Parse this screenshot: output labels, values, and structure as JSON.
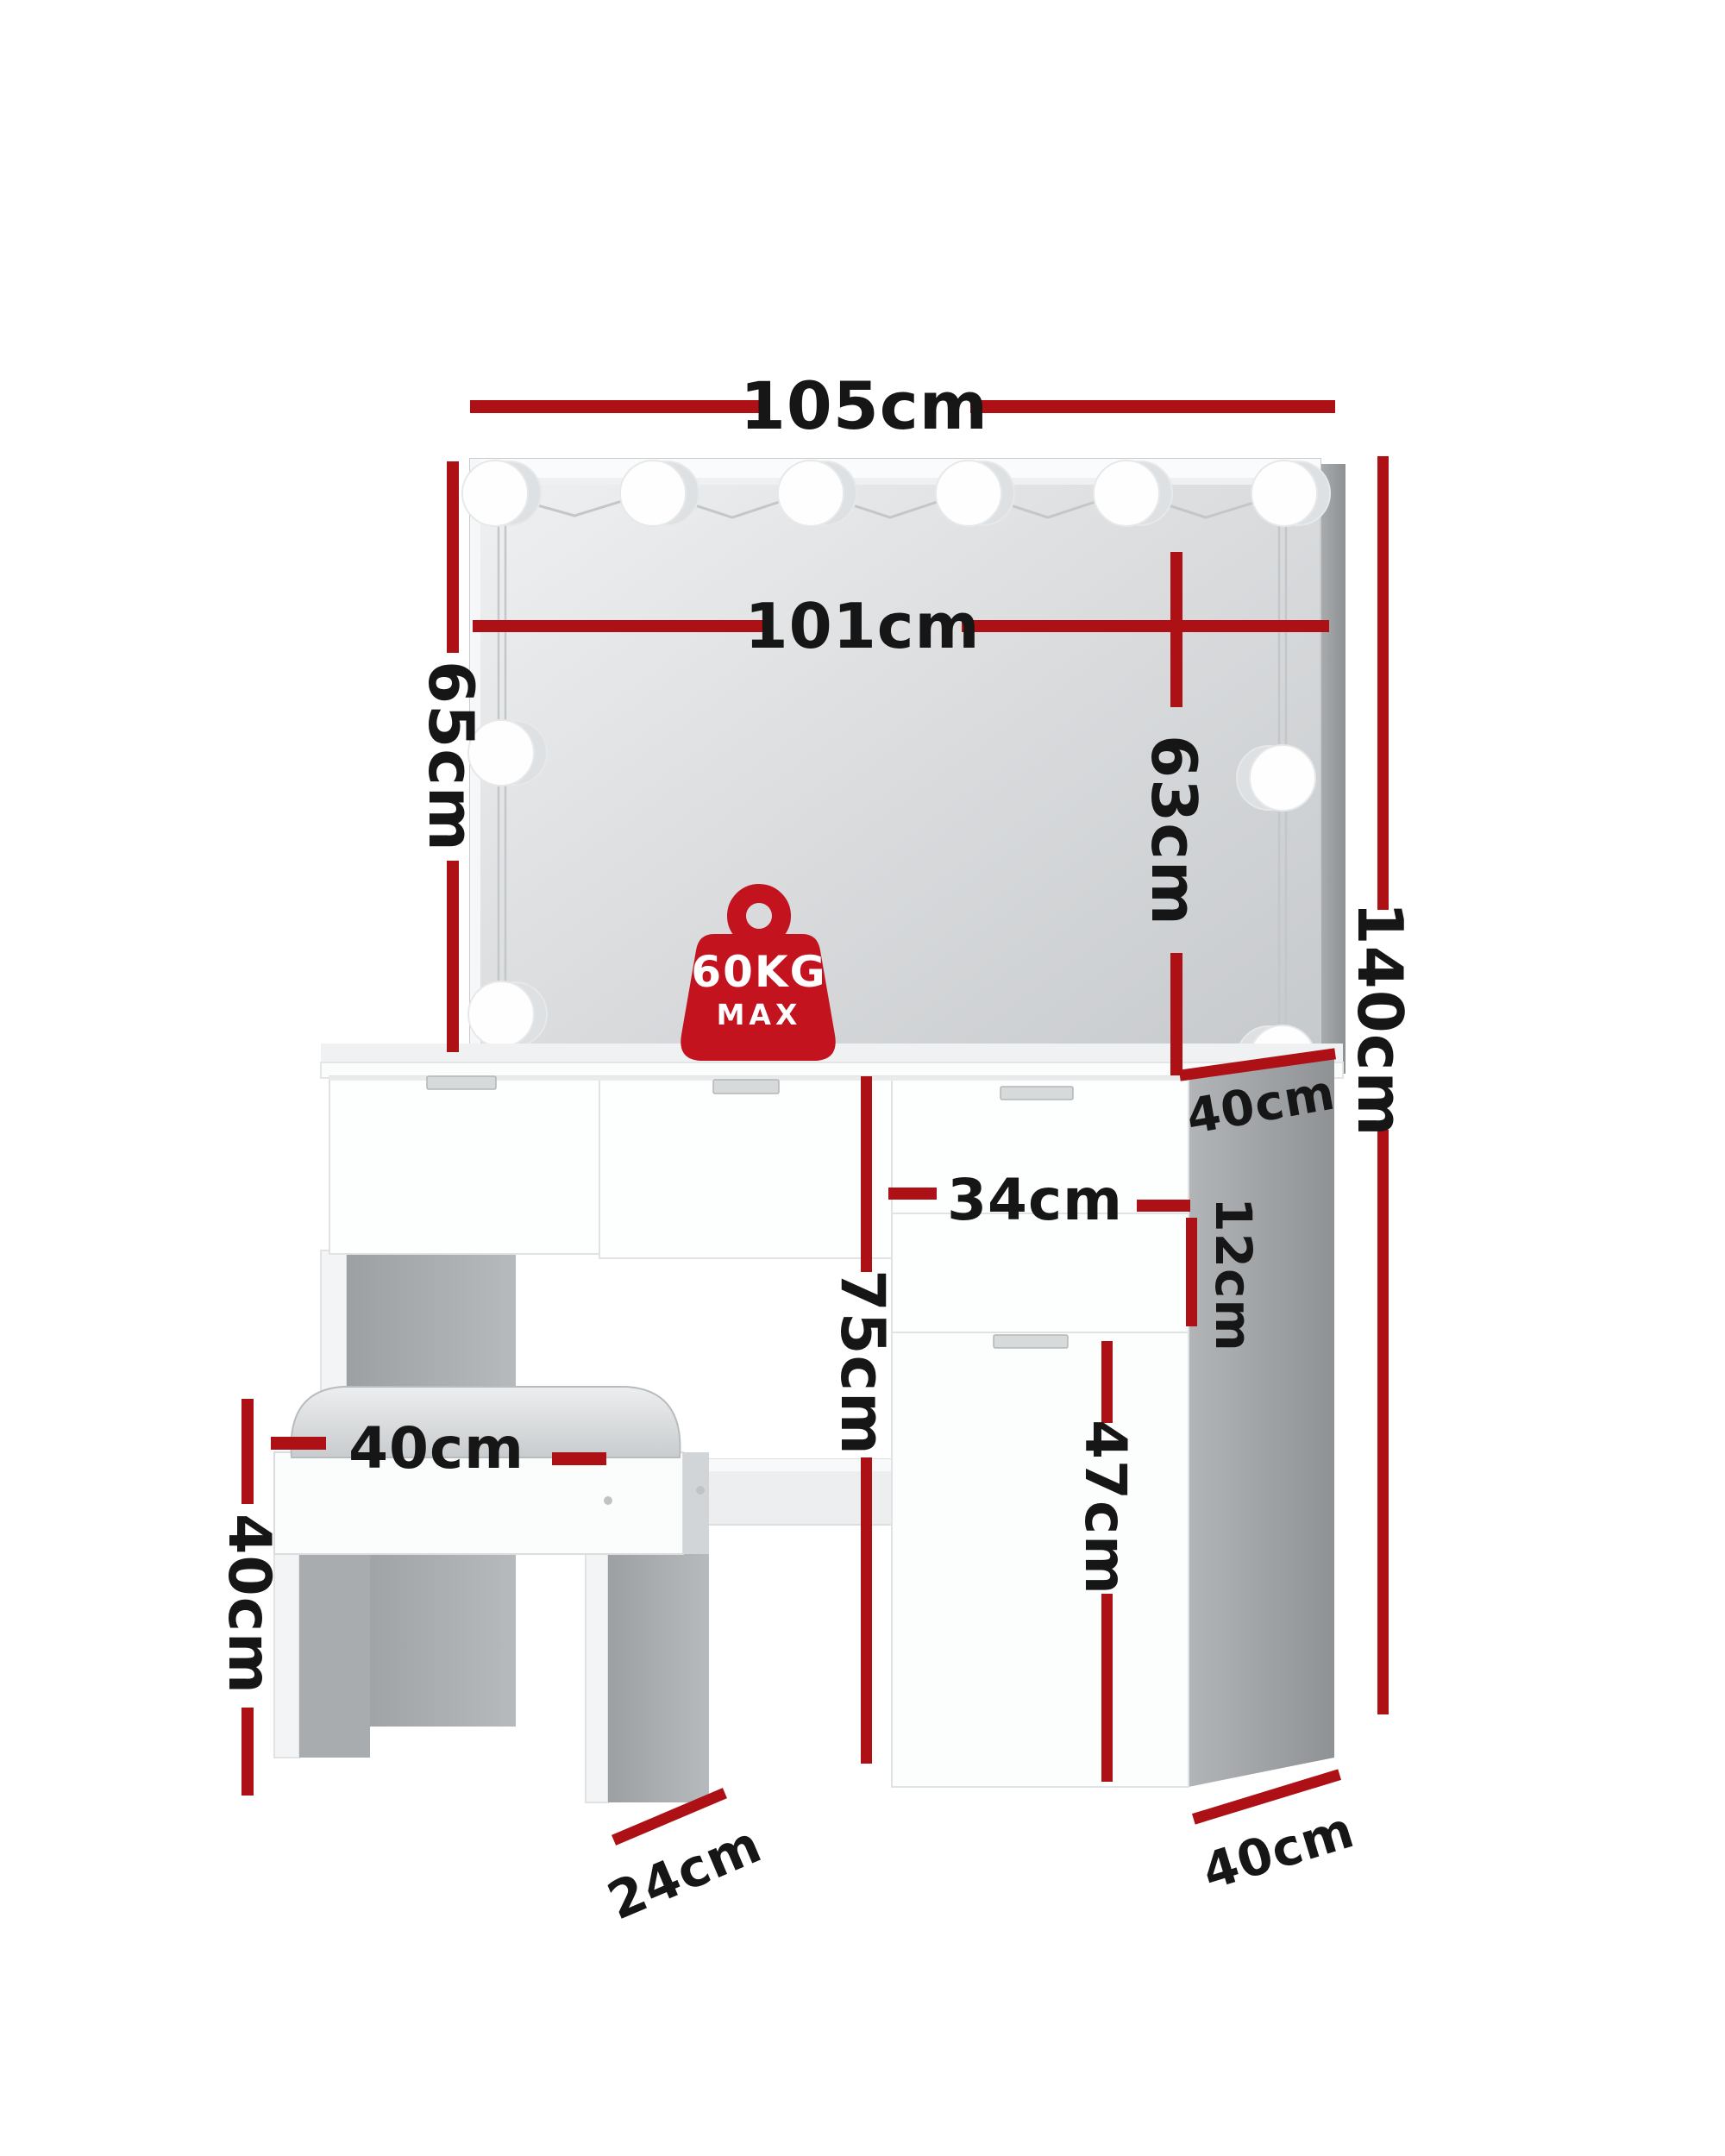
{
  "diagram": {
    "type": "furniture-dimension-diagram",
    "product": "dressing table with hollywood mirror, drawers and stool",
    "badge": {
      "weight": "60KG",
      "qualifier": "MAX"
    },
    "icons": {
      "badge": "weight-kettlebell-icon",
      "lights": "round-led-bulb"
    },
    "dimensions": {
      "mirror_width": "105cm",
      "lights_span_width": "101cm",
      "mirror_height_left": "65cm",
      "mirror_height_right": "63cm",
      "overall_height": "140cm",
      "tabletop_depth": "40cm",
      "drawer_width": "34cm",
      "drawer_height": "12cm",
      "tabletop_height": "75cm",
      "cabinet_door_height": "47cm",
      "stool_seat_width": "40cm",
      "stool_height": "40cm",
      "stool_depth": "24cm",
      "cabinet_depth": "40cm"
    },
    "colors": {
      "dimension_line": "#ad1015",
      "badge": "#c2131f",
      "text": "#161616",
      "furniture_white": "#fcfdfd",
      "furniture_gray": "#9b9ea2"
    }
  }
}
